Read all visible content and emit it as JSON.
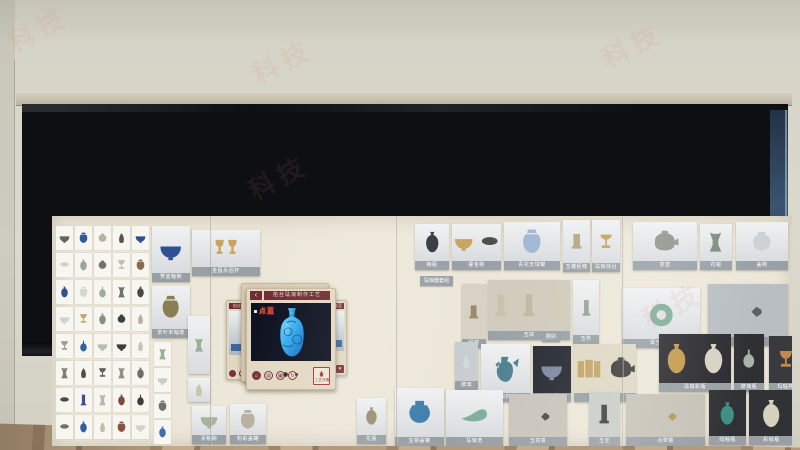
{
  "watermark": {
    "text": "科技",
    "color": "#cd807a"
  },
  "popup": {
    "title": "掐丝珐琅制作工艺",
    "back": "‹",
    "step": "点蓝",
    "prev": "掐丝",
    "next": "烧蓝",
    "detail_label": "工艺详情",
    "fav": "♥",
    "nav": [
      "⌂",
      "▤",
      "▦",
      "↻"
    ],
    "accent_color": "#6f2d33",
    "vase_color": "#2fa8e8"
  },
  "left_panel": {
    "featured": {
      "f1": {
        "caption": "霁蓝釉碗",
        "art": [
          {
            "shape": "bowl",
            "color": "#2e4f96"
          }
        ]
      },
      "f2": {
        "caption": "茶叶末釉尊",
        "art": [
          {
            "shape": "jar",
            "color": "#8a7f52"
          }
        ]
      }
    },
    "tiles": [
      {
        "shape": "bowl",
        "color": "#5f6557"
      },
      {
        "shape": "jar",
        "color": "#31589b"
      },
      {
        "shape": "pot",
        "color": "#b8b2a2"
      },
      {
        "shape": "figure",
        "color": "#55564f"
      },
      {
        "shape": "bowl",
        "color": "#2f4f93"
      },
      {
        "shape": "plate",
        "color": "#cfd3cd"
      },
      {
        "shape": "vase",
        "color": "#9aa795"
      },
      {
        "shape": "pot",
        "color": "#6f7466"
      },
      {
        "shape": "cup",
        "color": "#c3bca9"
      },
      {
        "shape": "jar",
        "color": "#8c6a4f"
      },
      {
        "shape": "vase",
        "color": "#334e8f"
      },
      {
        "shape": "jar",
        "color": "#d8d5ca"
      },
      {
        "shape": "bottle",
        "color": "#9cae9b"
      },
      {
        "shape": "gu",
        "color": "#6e7365"
      },
      {
        "shape": "vase",
        "color": "#474842"
      },
      {
        "shape": "bowl",
        "color": "#cdd2d4"
      },
      {
        "shape": "cup",
        "color": "#bfa76d"
      },
      {
        "shape": "vase",
        "color": "#8a8f7f"
      },
      {
        "shape": "pot",
        "color": "#3f4140"
      },
      {
        "shape": "figure",
        "color": "#b9b29e"
      },
      {
        "shape": "cup",
        "color": "#9c9c94"
      },
      {
        "shape": "bottle",
        "color": "#35609f"
      },
      {
        "shape": "bowl",
        "color": "#b7bdb4"
      },
      {
        "shape": "bowl",
        "color": "#3c3e39"
      },
      {
        "shape": "figure",
        "color": "#c8c4b2"
      },
      {
        "shape": "gu",
        "color": "#7b8072"
      },
      {
        "shape": "figure",
        "color": "#4e5048"
      },
      {
        "shape": "cup",
        "color": "#5d6156"
      },
      {
        "shape": "gu",
        "color": "#8e937f"
      },
      {
        "shape": "vase",
        "color": "#6b7062"
      },
      {
        "shape": "plate",
        "color": "#4a4d45"
      },
      {
        "shape": "pillar",
        "color": "#40538f"
      },
      {
        "shape": "gu",
        "color": "#b4b9ae"
      },
      {
        "shape": "vase",
        "color": "#7e4a3e"
      },
      {
        "shape": "bottle",
        "color": "#3d3f3a"
      },
      {
        "shape": "plate",
        "color": "#6e7264"
      },
      {
        "shape": "vase",
        "color": "#2f5d9e"
      },
      {
        "shape": "figure",
        "color": "#c2bdab"
      },
      {
        "shape": "jar",
        "color": "#8c5140"
      },
      {
        "shape": "bowl",
        "color": "#cfd2c9"
      }
    ],
    "extra_tiles": [
      {
        "shape": "gu",
        "color": "#9cae98"
      },
      {
        "shape": "bowl",
        "color": "#c9cdc4"
      },
      {
        "shape": "jar",
        "color": "#6f7466"
      },
      {
        "shape": "vase",
        "color": "#3f6fae"
      }
    ]
  },
  "mid_column": {
    "m1": {
      "caption": "金瓯永固杯",
      "art": [
        {
          "shape": "cups",
          "color": "#c9a35f"
        }
      ]
    },
    "m2": {
      "caption": "",
      "art": [
        {
          "shape": "gu",
          "color": "#9cae92"
        }
      ]
    },
    "m3": {
      "caption": "",
      "art": [
        {
          "shape": "figure",
          "color": "#c9c2ae"
        }
      ]
    },
    "m4": {
      "caption": "青釉碗",
      "art": [
        {
          "shape": "bowl",
          "color": "#a8b39e"
        }
      ]
    },
    "m5": {
      "caption": "粉彩盖罐",
      "art": [
        {
          "shape": "jar",
          "color": "#b8b0a0"
        }
      ]
    }
  },
  "right_cards": {
    "r1": {
      "caption": "梅瓶",
      "art": [
        {
          "shape": "vase",
          "color": "#30343c"
        }
      ]
    },
    "r2": {
      "caption": "鎏金碗",
      "art": [
        {
          "shape": "bowl",
          "color": "#c9a35f"
        },
        {
          "shape": "plate",
          "color": "#4d4f4a"
        }
      ]
    },
    "r3": {
      "caption": "青花天球罐",
      "art": [
        {
          "shape": "jar",
          "color": "#9fb6d4"
        }
      ]
    },
    "r4": {
      "caption": "玉雕经幢",
      "art": [
        {
          "shape": "stele",
          "color": "#b3a586"
        }
      ]
    },
    "r5": {
      "caption": "珐琅烛台",
      "art": [
        {
          "shape": "stem",
          "color": "#c8a05c"
        }
      ]
    },
    "r6": {
      "caption": "茶壶",
      "art": [
        {
          "shape": "teapot",
          "color": "#8f9289"
        }
      ]
    },
    "r7": {
      "caption": "花觚",
      "art": [
        {
          "shape": "gu",
          "color": "#7d8a7f"
        }
      ]
    },
    "r8": {
      "caption": "盖碗",
      "art": [
        {
          "shape": "pot",
          "color": "#ccd2d4"
        }
      ]
    },
    "r9": {
      "caption": "珐琅器套组"
    },
    "r10": {
      "caption": "经幢",
      "bg": "#d8d2c4",
      "art": [
        {
          "shape": "stele",
          "color": "#9a8a6a"
        }
      ]
    },
    "r11": {
      "caption": "玉琮",
      "cap2": "刚卯",
      "bg": "#cfcabb",
      "art": [
        {
          "shape": "pillar",
          "color": "#c9c0a8"
        },
        {
          "shape": "pillar",
          "color": "#bfb69e"
        },
        {
          "shape": "pillar",
          "color": "#d2c9b0"
        }
      ]
    },
    "r12": {
      "caption": "玉杵",
      "art": [
        {
          "shape": "pillar",
          "color": "#98a294"
        }
      ]
    },
    "r13": {
      "caption": "翠玉手镯",
      "art": [
        {
          "shape": "ring",
          "color": "#7fae9a"
        }
      ]
    },
    "r14": {
      "caption": "香囊坠",
      "bg": "#b9bec2",
      "art": [
        {
          "shape": "pin",
          "color": "#5c5f66"
        }
      ]
    },
    "r15": {
      "caption": "玻璃",
      "bg": "#c8cdd1",
      "art": [
        {
          "shape": "figure",
          "color": "#d2dade"
        }
      ]
    },
    "r16": {
      "caption": "珐琅执壶",
      "art": [
        {
          "shape": "ewer",
          "color": "#4a7f8c"
        }
      ]
    },
    "r17": {
      "caption": "钧窑碗",
      "bg": "#23262e",
      "art": [
        {
          "shape": "bowl",
          "color": "#7d86a0"
        }
      ]
    },
    "r18": {
      "caption": "紫砂壶",
      "bg": "#ded7c2",
      "art": [
        {
          "shape": "screen",
          "color": "#c1a365"
        },
        {
          "shape": "teapot",
          "color": "#3c3a36"
        }
      ]
    },
    "r19": {
      "caption": "珐琅彩瓶",
      "bg": "#2c2c30",
      "art": [
        {
          "shape": "vase",
          "color": "#c39a4e"
        },
        {
          "shape": "vase",
          "color": "#d8d2c4"
        }
      ]
    },
    "r20": {
      "caption": "玻璃瓶",
      "bg": "#2e3034",
      "art": [
        {
          "shape": "bottle",
          "color": "#a9b3ab"
        }
      ]
    },
    "r21": {
      "caption": "玛瑙杯",
      "bg": "#3a3a3e",
      "art": [
        {
          "shape": "cup",
          "color": "#bf8a4a"
        }
      ]
    },
    "r22": {
      "caption": "花瓶",
      "art": [
        {
          "shape": "vase",
          "color": "#998e70"
        }
      ]
    },
    "r23": {
      "caption": "宝相盖罐",
      "art": [
        {
          "shape": "pot",
          "color": "#3f7fae"
        }
      ]
    },
    "r24": {
      "caption": "珐琅洗",
      "art": [
        {
          "shape": "boat",
          "color": "#7fae9a"
        }
      ]
    },
    "r25": {
      "caption": "玉如意",
      "bg": "#c9c4ba",
      "art": [
        {
          "shape": "pin",
          "color": "#4e4a42"
        }
      ]
    },
    "r26": {
      "caption": "玉圭",
      "bg": "#caccc6",
      "art": [
        {
          "shape": "pillar",
          "color": "#3d403b"
        }
      ]
    },
    "r27": {
      "caption": "点翠簪",
      "bg": "#c6c2b6",
      "art": [
        {
          "shape": "pin",
          "color": "#b3975c"
        }
      ]
    },
    "r28": {
      "caption": "绿釉瓶",
      "bg": "#2f3134",
      "art": [
        {
          "shape": "vase",
          "color": "#3f8f84"
        }
      ]
    },
    "r29": {
      "caption": "彩绘瓶",
      "bg": "#303236",
      "art": [
        {
          "shape": "vase",
          "color": "#d6d0bc"
        }
      ]
    }
  }
}
